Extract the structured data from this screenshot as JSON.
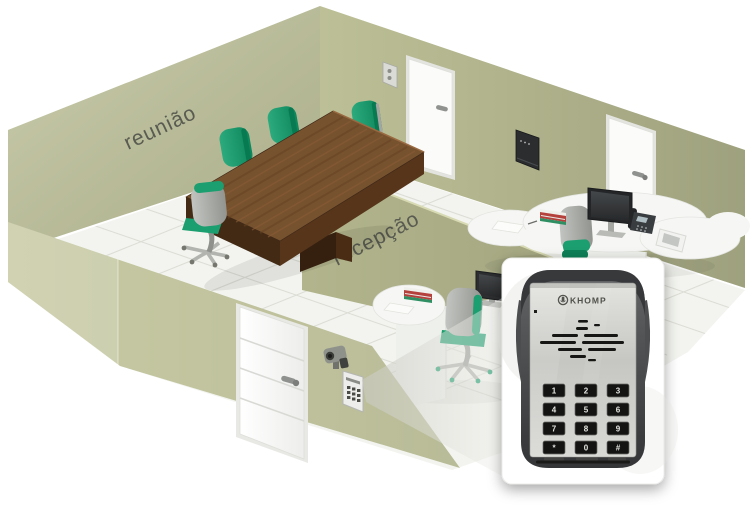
{
  "scene": {
    "room_labels": {
      "meeting": "reunião",
      "reception": "recepção"
    }
  },
  "intercom_inset": {
    "brand": "KHOMP",
    "keypad_keys": [
      "1",
      "2",
      "3",
      "4",
      "5",
      "6",
      "7",
      "8",
      "9",
      "*",
      "0",
      "#"
    ]
  },
  "colors": {
    "floor": "#f3f4ef",
    "floor_line": "#d9dbd2",
    "wall_left": "#c2c59d",
    "wall_right": "#bdc096",
    "wall_divider": "#b2b58c",
    "wall_front": "#c7caa3",
    "accent_green": "#1b9e70",
    "accent_green_dark": "#0c7f56",
    "chair_gray": "#a9aba7",
    "table_wood": "#77522f",
    "table_wood_dark": "#4a2d17",
    "desk_white": "#f6f7f4",
    "door_white": "#fbfbf9",
    "beam": "#d9d9d2",
    "device_steel": "#cfcfcb",
    "device_casing": "#3f4143",
    "key_black": "#141413"
  }
}
